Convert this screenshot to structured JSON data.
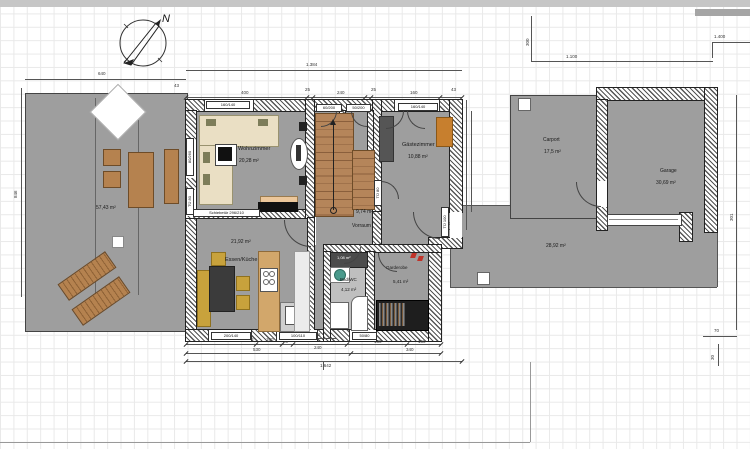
{
  "compass": {
    "north_label": "N"
  },
  "rooms": {
    "terrasse": {
      "area": "57,43 m²"
    },
    "wohnzimmer": {
      "name": "Wohnzimmer",
      "area": "20,28 m²"
    },
    "gaestezimmer": {
      "name": "Gästezimmer",
      "area": "10,88 m²"
    },
    "vorraum": {
      "name": "Vorraum",
      "area": "9,74 m²"
    },
    "essen_kueche": {
      "name": "Essen/Küche",
      "area": "21,92 m²"
    },
    "bad_wc": {
      "name": "Bad/WC",
      "area": "4,12 m²"
    },
    "abstellraum": {
      "area": "1,08 m²"
    },
    "garderobe": {
      "name": "Garderobe",
      "area": "5,41 m²"
    },
    "carport": {
      "name": "Carport",
      "area": "17,5 m²"
    },
    "garage": {
      "name": "Garage",
      "area": "30,69 m²"
    },
    "zufahrt": {
      "area": "28,92 m²"
    }
  },
  "openings": {
    "schiebetuer": "Schiebetür 296/210",
    "window_160_140_a": "160/140",
    "window_160_140_b": "160/140",
    "door_60_200": "60/200",
    "door_50_200": "50/200",
    "window_200_140": "200/140",
    "window_100_110": "100/110",
    "window_50_80": "50/80",
    "door_80_260": "80/260",
    "door_tu80_a": "TÜ 80",
    "door_tu80_b": "TÜ 80",
    "door_tu100": "TÜ 100"
  },
  "dimensions": {
    "top_total": "1.384",
    "top_chain": [
      "400",
      "25",
      "240",
      "25",
      "160",
      "43"
    ],
    "top_small": "43",
    "right_total": "1.100",
    "carport_offset": "300",
    "corner_total": "1.400",
    "left_width": "640",
    "left_height": "846",
    "bottom_chain": [
      "268",
      "100",
      "20",
      "132",
      "240",
      "130",
      "160"
    ],
    "bottom_row2": [
      "530",
      "340"
    ],
    "bottom_total": "1.642",
    "entry_width": "131",
    "garage_side": "301",
    "step_width": "70",
    "step_height": "30"
  },
  "palette": {
    "floor_gray": "#9e9e9e",
    "wood": "#b5824f",
    "sofa_beige": "#eadfc4",
    "kitchen_wood": "#d2a76b",
    "accent_mustard": "#c8a23c",
    "accent_teal": "#4a9a8c",
    "accent_orange": "#c77f2e",
    "symbol_red": "#c03228",
    "dark_furniture": "#2b2b2b"
  }
}
